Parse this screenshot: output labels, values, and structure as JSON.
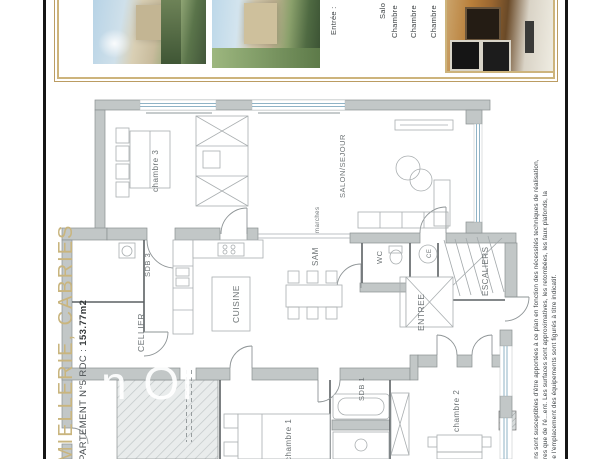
{
  "branding": {
    "title": "MIELLERIE, CABRIES",
    "apartment_line_prefix": "PARTEMENT N°5 RDC : ",
    "apartment_area": "153.77m2"
  },
  "header_legend": {
    "line1": "Entrée :",
    "line2": "Salo",
    "line3": "Chambre",
    "line4": "Chambre",
    "line5": "Chambre"
  },
  "plan_labels": {
    "chambre3": "chambre 3",
    "salon": "SALON/SEJOUR",
    "marches": "marches",
    "sam": "SAM",
    "cuisine": "CUISINE",
    "sdb3": "SDB 3",
    "cellier": "CELLIER",
    "wc": "WC",
    "ce": "CE",
    "escaliers": "ESCALIERS",
    "entree": "ENTREE",
    "sdb1": "SDB 1",
    "chambre1": "chambre 1",
    "chambre2": "chambre 2"
  },
  "watermark": "n Of",
  "disclaimer": {
    "line1": "tions sont susceptibles d'être apportées à ce plan en fonction  des nécessités techniques de réalisation,",
    "line2": "libres que de l'é...ent. Les surfaces sont approximatives, les retombées, les faux plafonds, la",
    "line3": "que l'emplacement des équipements sont figurés à titre indicatif."
  },
  "colors": {
    "gold": "#bb9c62",
    "gold_text": "#c9b57e",
    "wall": "#c2c7c7",
    "window": "#8fb3c6"
  }
}
